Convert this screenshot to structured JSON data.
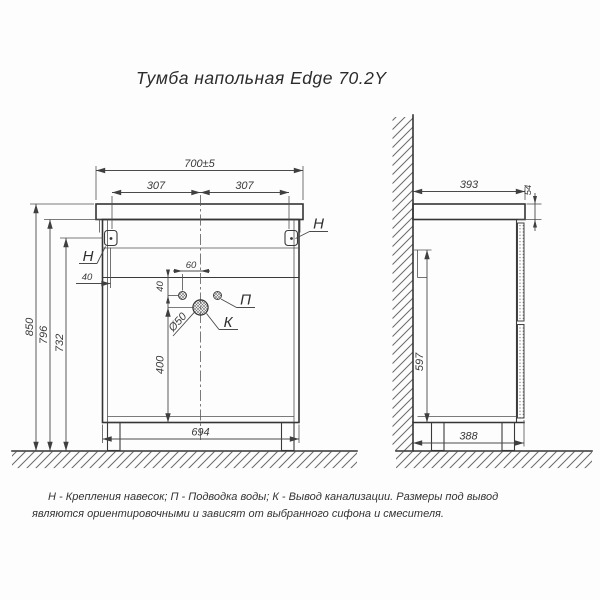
{
  "title": "Тумба напольная Edge 70.2Y",
  "note": "Н - Крепления навесок; П - Подводка воды; К - Вывод канализации. Размеры под вывод являются ориентировочными и зависят от выбранного сифона и смесителя.",
  "front_view": {
    "dim_overall_width": "700±5",
    "dim_bracket_span_left": "307",
    "dim_bracket_span_right": "307",
    "dim_height_total": "850",
    "dim_height_to_cabinet_top": "796",
    "dim_height_to_bracket": "732",
    "dim_bracket_inset": "40",
    "dim_supply_offset": "60",
    "dim_supply_drop": "40",
    "dim_drain_diameter": "Ø50",
    "dim_drain_to_bottom": "400",
    "dim_base_width": "694",
    "label_bracket_left": "Н",
    "label_bracket_right": "Н",
    "label_supply": "П",
    "label_drain": "К"
  },
  "side_view": {
    "dim_depth": "393",
    "dim_countertop_thickness": "54",
    "dim_front_height": "597",
    "dim_base_depth": "388"
  }
}
